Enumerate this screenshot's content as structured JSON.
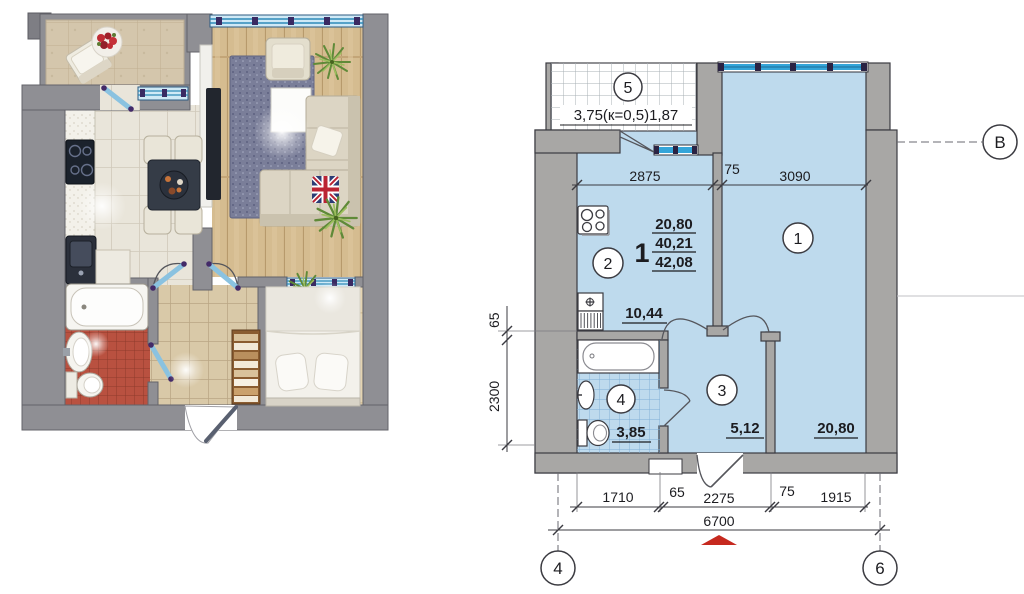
{
  "palette": {
    "paper": "#ffffff",
    "wall_gray_tech": "#a8a7a5",
    "wall_gray_render": "#8f8f94",
    "room_blue": "#bedaed",
    "window_cyan": "#35a5d9",
    "line_dark": "#3b3b41",
    "red_arrow": "#c6291f",
    "bath_tile_red": "#b95140",
    "wood_floor": "#d5bc90",
    "rug_blue": "#7a7e99"
  },
  "plan": {
    "axes": {
      "b": "В",
      "bottom_left": "4",
      "bottom_right": "6"
    },
    "apartment": {
      "number": "1",
      "areas": [
        "20,80",
        "40,21",
        "42,08"
      ]
    },
    "balcony": {
      "number": "5",
      "label": "3,75(к=0,5)1,87"
    },
    "rooms": {
      "room1": {
        "number": "1",
        "area": "20,80"
      },
      "kitchen": {
        "number": "2",
        "area": "10,44"
      },
      "hall": {
        "number": "3",
        "area": "5,12"
      },
      "bath": {
        "number": "4",
        "area": "3,85"
      }
    },
    "dims": {
      "top": [
        "2875",
        "75",
        "3090"
      ],
      "left": [
        "65",
        "2300"
      ],
      "bottom": [
        "1710",
        "65",
        "2275",
        "75",
        "1915"
      ],
      "total": "6700"
    }
  }
}
